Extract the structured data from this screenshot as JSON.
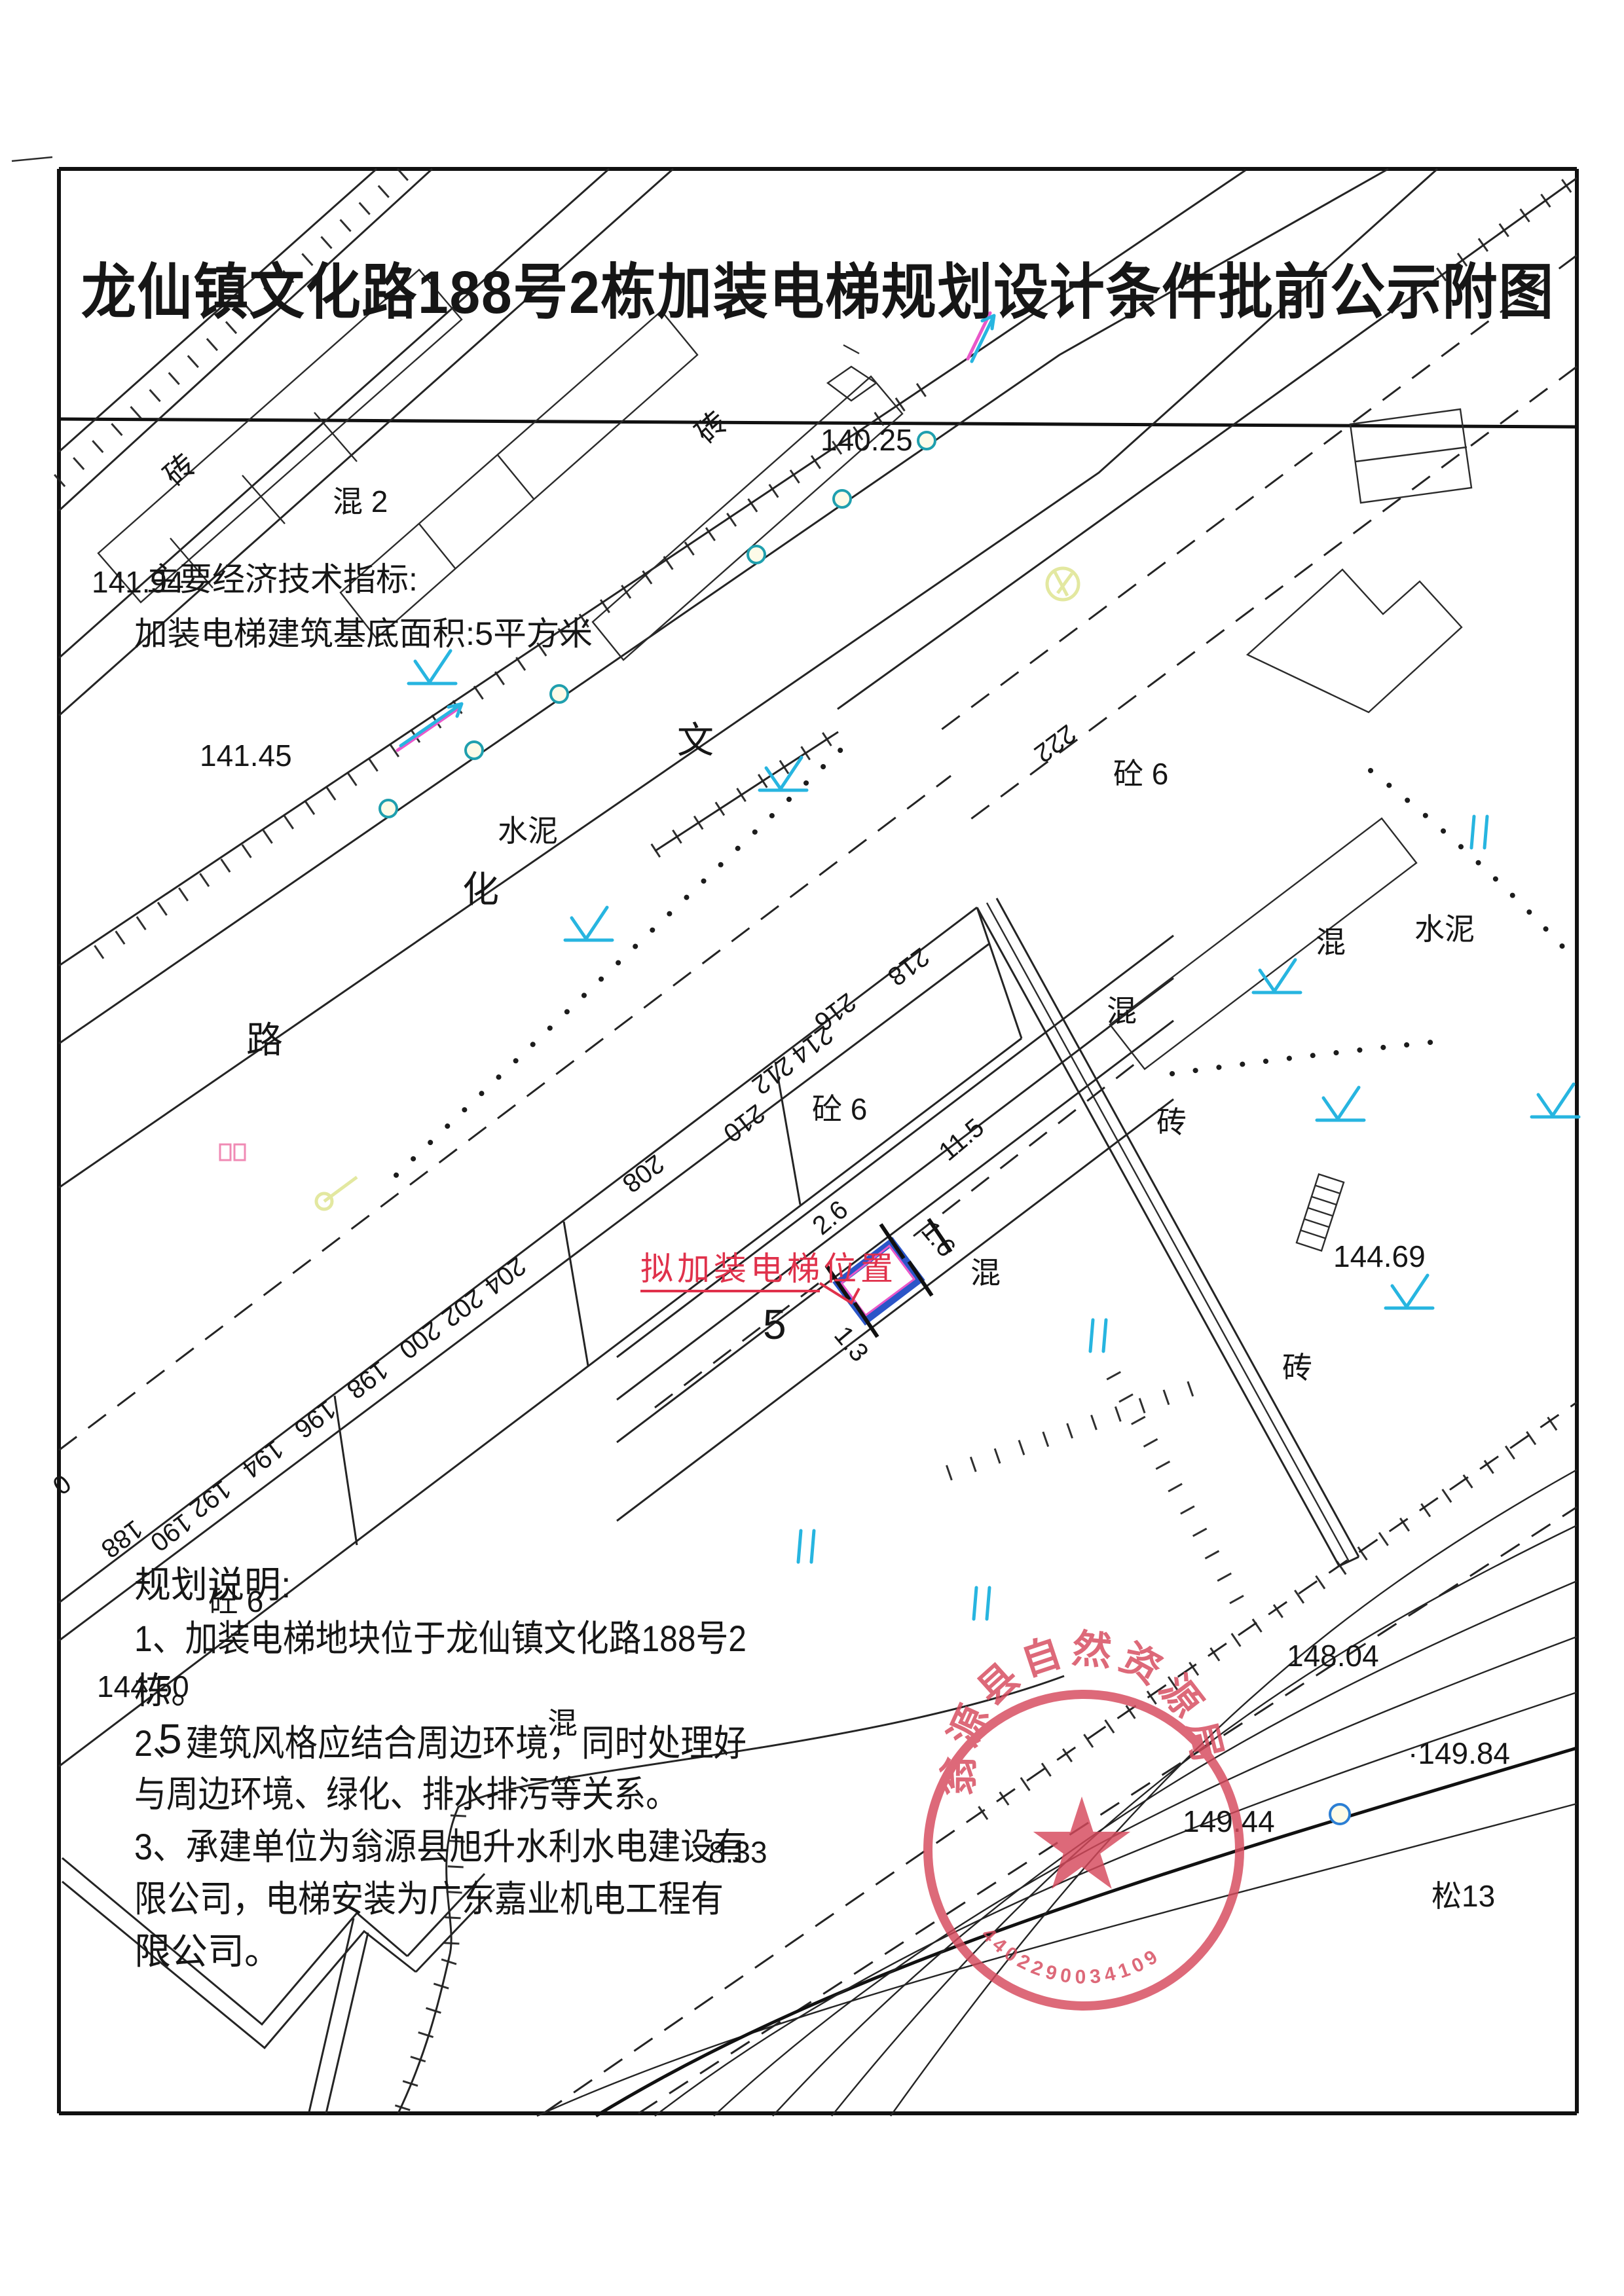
{
  "page": {
    "title": "龙仙镇文化路188号2栋加装电梯规划设计条件批前公示附图"
  },
  "tech": {
    "header": "主要经济技术指标:",
    "area_line": "加装电梯建筑基底面积:5平方米"
  },
  "notes": {
    "header": "规划说明:",
    "line1": "1、加装电梯地块位于龙仙镇文化路188号2",
    "line2": "栋。",
    "line3": "2、建筑风格应结合周边环境，同时处理好",
    "line4": "与周边环境、绿化、排水排污等关系。",
    "line5": "3、承建单位为翁源县旭升水利水电建设有",
    "line6": "限公司，电梯安装为广东嘉业机电工程有",
    "line7": "限公司。"
  },
  "annotation": {
    "elevator_label": "拟加装电梯位置"
  },
  "street": {
    "c1": "文",
    "c2": "化",
    "c3": "路"
  },
  "materials": {
    "brick": "砖",
    "mix": "混",
    "mix2": "混 2",
    "conc6": "砼 6",
    "cement": "水泥",
    "pine13": "松13"
  },
  "numbers": {
    "n188": "188",
    "n190": "190",
    "n192": "192",
    "n194": "194",
    "n196": "196",
    "n198": "198",
    "n200": "200",
    "n202": "202",
    "n204": "204",
    "n208": "208",
    "n210": "210",
    "n212": "212",
    "n214": "214",
    "n216": "216",
    "n218": "218",
    "n222": "222",
    "n0": "0"
  },
  "dims": {
    "d115": "11.5",
    "d26": "2.6",
    "d16": "1.6",
    "d13": "1.3",
    "storey5": "5",
    "storey5b": "5"
  },
  "elevations": {
    "e14025": "140.25",
    "e14194": "141.94",
    "e14145": "141.45",
    "e14469": "144.69",
    "e14450": "144.50",
    "e14804": "148.04",
    "e14984": "·149.84",
    "e14944": "149.44",
    "e833": "8.33"
  },
  "seal": {
    "agency": "翁源县自然资源局",
    "code": "4402290034109"
  },
  "palette": {
    "ink": "#242424",
    "annotation_red": "#e0314b",
    "seal_red": "#d6495c",
    "elevator_blue": "#2b55c8",
    "magenta": "#e957c9",
    "symbol_cyan": "#27b5e0",
    "survey_teal": "#1f9fae",
    "tree_yellow": "#e3e8a0",
    "pink": "#f08ab4"
  }
}
